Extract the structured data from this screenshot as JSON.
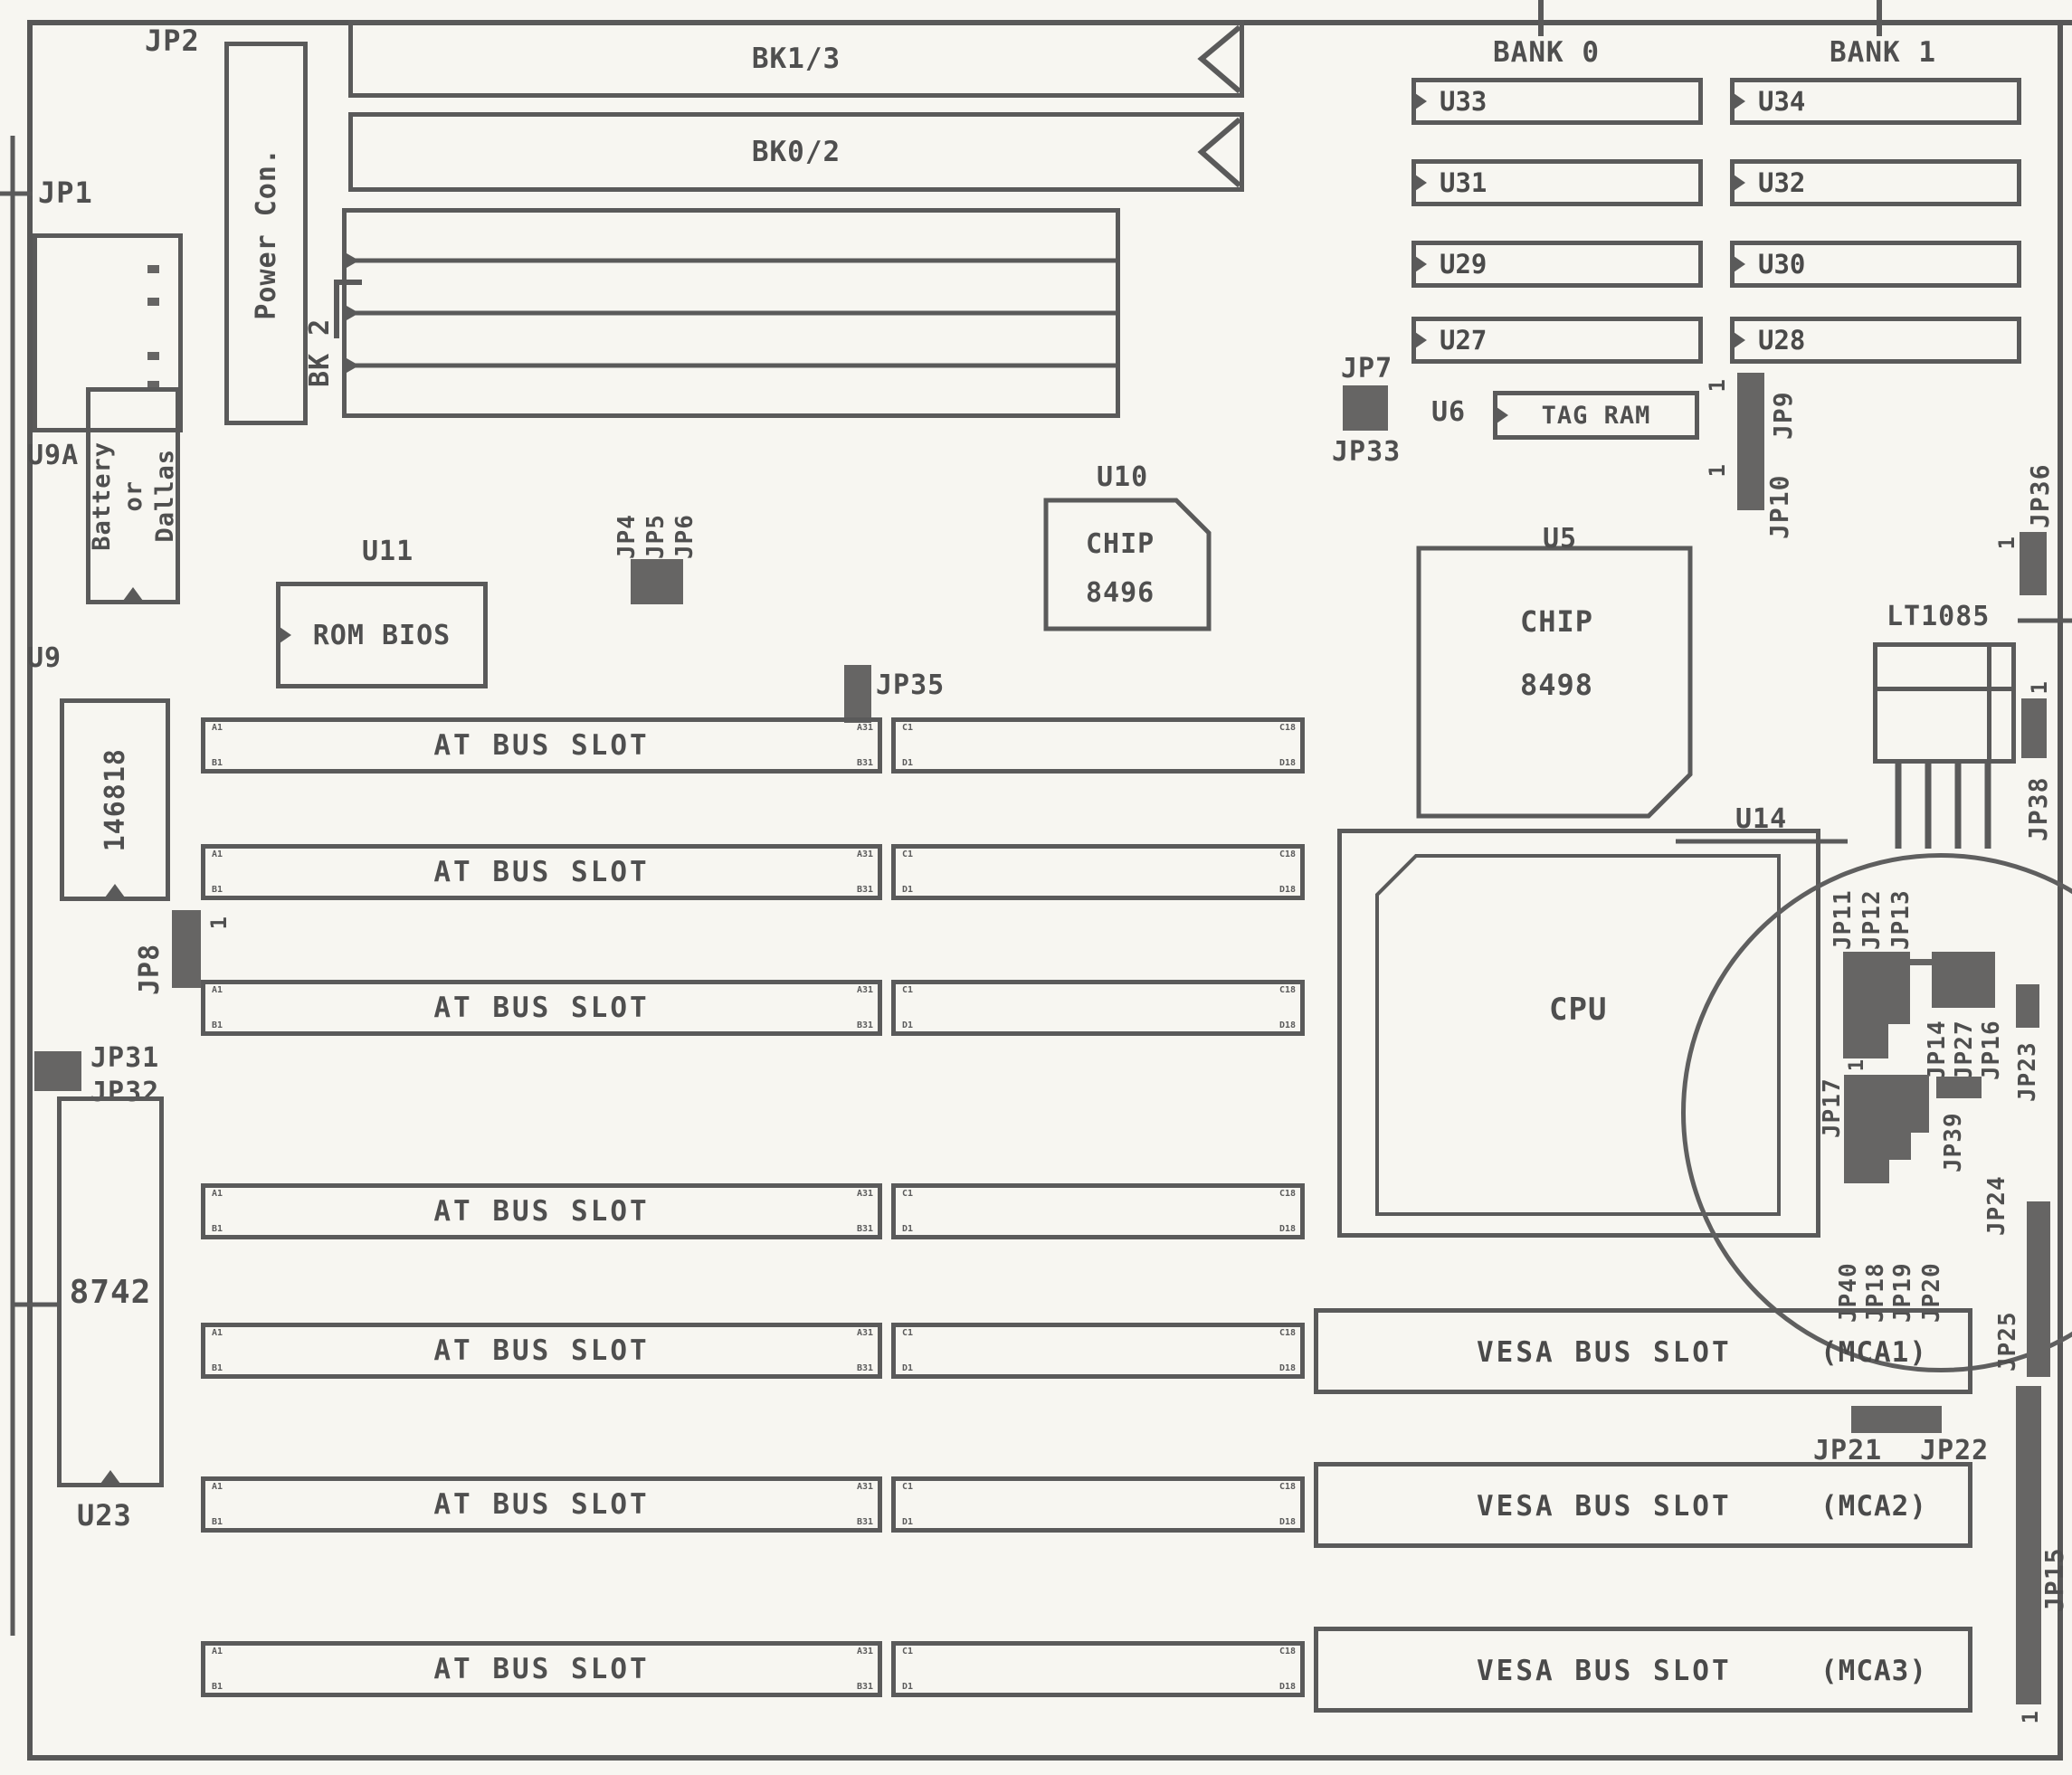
{
  "figure": {
    "kind": "motherboard layout diagram (scanned manual page)"
  },
  "labels": {
    "jp1": "JP1",
    "jp2": "JP2",
    "u9a": "U9A",
    "power_con": "Power Con.",
    "bk1_3": "BK1/3",
    "bk0_2": "BK0/2",
    "bk2": "BK 2",
    "battery_line1": "Battery",
    "battery_line2": "or",
    "battery_line3": "Dallas",
    "u9": "U9",
    "rtc": "146818",
    "u11": "U11",
    "rom_bios": "ROM BIOS",
    "jp4": "JP4",
    "jp5": "JP5",
    "jp6": "JP6",
    "jp35": "JP35",
    "u10": "U10",
    "u10_chip": "CHIP",
    "u10_num": "8496",
    "bank0": "BANK 0",
    "bank1": "BANK 1",
    "u33": "U33",
    "u31": "U31",
    "u29": "U29",
    "u27": "U27",
    "u34": "U34",
    "u32": "U32",
    "u30": "U30",
    "u28": "U28",
    "jp7": "JP7",
    "jp33": "JP33",
    "u6": "U6",
    "tag_ram": "TAG RAM",
    "jp9": "JP9",
    "jp10": "JP10",
    "u5": "U5",
    "u5_chip": "CHIP",
    "u5_num": "8498",
    "lt1085": "LT1085",
    "jp36": "JP36",
    "jp38": "JP38",
    "u14": "U14",
    "cpu": "CPU",
    "jp11": "JP11",
    "jp12": "JP12",
    "jp13": "JP13",
    "jp14": "JP14",
    "jp27": "JP27",
    "jp16": "JP16",
    "jp23": "JP23",
    "jp17": "JP17",
    "jp39": "JP39",
    "jp40": "JP40",
    "jp18": "JP18",
    "jp19": "JP19",
    "jp20": "JP20",
    "jp24": "JP24",
    "jp25": "JP25",
    "jp21": "JP21",
    "jp22": "JP22",
    "jp15": "JP15",
    "jp8": "JP8",
    "jp31": "JP31",
    "jp32": "JP32",
    "kbc": "8742",
    "u23": "U23",
    "at_slot": "AT BUS SLOT",
    "vesa_slot": "VESA BUS SLOT",
    "mca1": "(MCA1)",
    "mca2": "(MCA2)",
    "mca3": "(MCA3)",
    "pin1": "1"
  },
  "pins": {
    "a1": "A1",
    "b1": "B1",
    "a31": "A31",
    "b31": "B31",
    "c1": "C1",
    "d1": "D1",
    "c18": "C18",
    "d18": "D18"
  }
}
